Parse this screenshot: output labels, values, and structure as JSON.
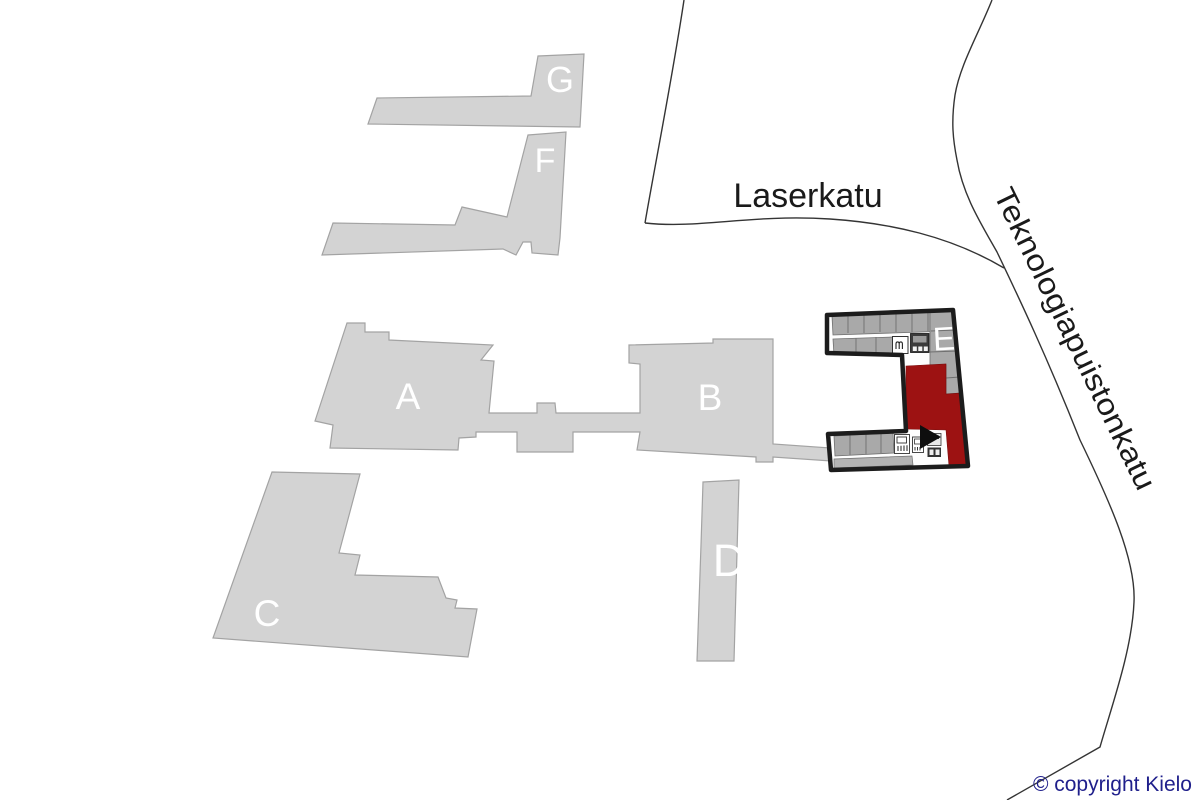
{
  "streets": {
    "laserkatu": "Laserkatu",
    "teknologiapuistonkatu": "Teknologiapuistonkatu"
  },
  "buildings": [
    {
      "label": "A",
      "highlighted": false
    },
    {
      "label": "B",
      "highlighted": false
    },
    {
      "label": "C",
      "highlighted": false
    },
    {
      "label": "D",
      "highlighted": false
    },
    {
      "label": "E",
      "highlighted": true
    },
    {
      "label": "F",
      "highlighted": false
    },
    {
      "label": "G",
      "highlighted": false
    }
  ],
  "floorplan": {
    "building": "E",
    "icons": [
      "entrance-arrow-icon",
      "elevator-icon",
      "stairs-icon"
    ]
  },
  "legend": {
    "copyright": "© copyright Kielo"
  },
  "colors": {
    "building_fill": "#d3d3d3",
    "building_stroke": "#a3a3a3",
    "highlight_red": "#9d1212",
    "floorplan_outline": "#1c1c1c",
    "room_gray": "#a9a9a9",
    "street_line": "#343434",
    "street_text": "#1a1a1a",
    "copyright_text": "#1f1f8b"
  }
}
